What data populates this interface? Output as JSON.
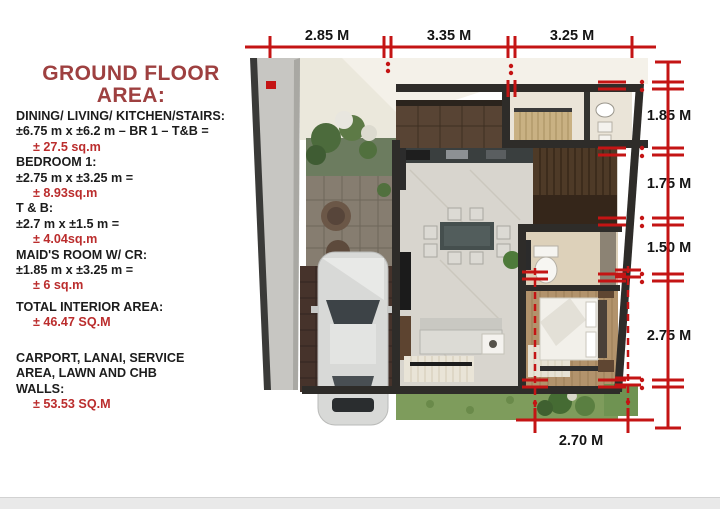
{
  "title": {
    "line1": "GROUND FLOOR",
    "line2": "AREA:",
    "color": "#9e4040"
  },
  "area_details": [
    {
      "label": "DINING/ LIVING/ KITCHEN/STAIRS:",
      "formula": "±6.75 m x ±6.2 m – BR 1 – T&B  =",
      "value": "± 27.5 sq.m"
    },
    {
      "label": "BEDROOM 1:",
      "formula": "±2.75 m x ±3.25 m =",
      "value": "± 8.93sq.m"
    },
    {
      "label": "T & B:",
      "formula": "±2.7 m x ±1.5 m =",
      "value": "± 4.04sq.m"
    },
    {
      "label": "MAID'S ROOM W/ CR:",
      "formula": "±1.85 m x ±3.25 m =",
      "value": "± 6 sq.m"
    }
  ],
  "totals": [
    {
      "label": "TOTAL INTERIOR AREA:",
      "value": "± 46.47 SQ.M"
    },
    {
      "label": "CARPORT, LANAI, SERVICE\nAREA, LAWN AND CHB\nWALLS:",
      "value": "± 53.53 SQ.M"
    }
  ],
  "dimensions": {
    "top": [
      "2.85 M",
      "3.35 M",
      "3.25 M"
    ],
    "right": [
      "1.85 M",
      "1.75 M",
      "1.50 M",
      "2.75 M"
    ],
    "bottom": [
      "2.70 M"
    ],
    "line_color": "#c41414",
    "label_color": "#141414",
    "value_color": "#bb2d2d"
  }
}
